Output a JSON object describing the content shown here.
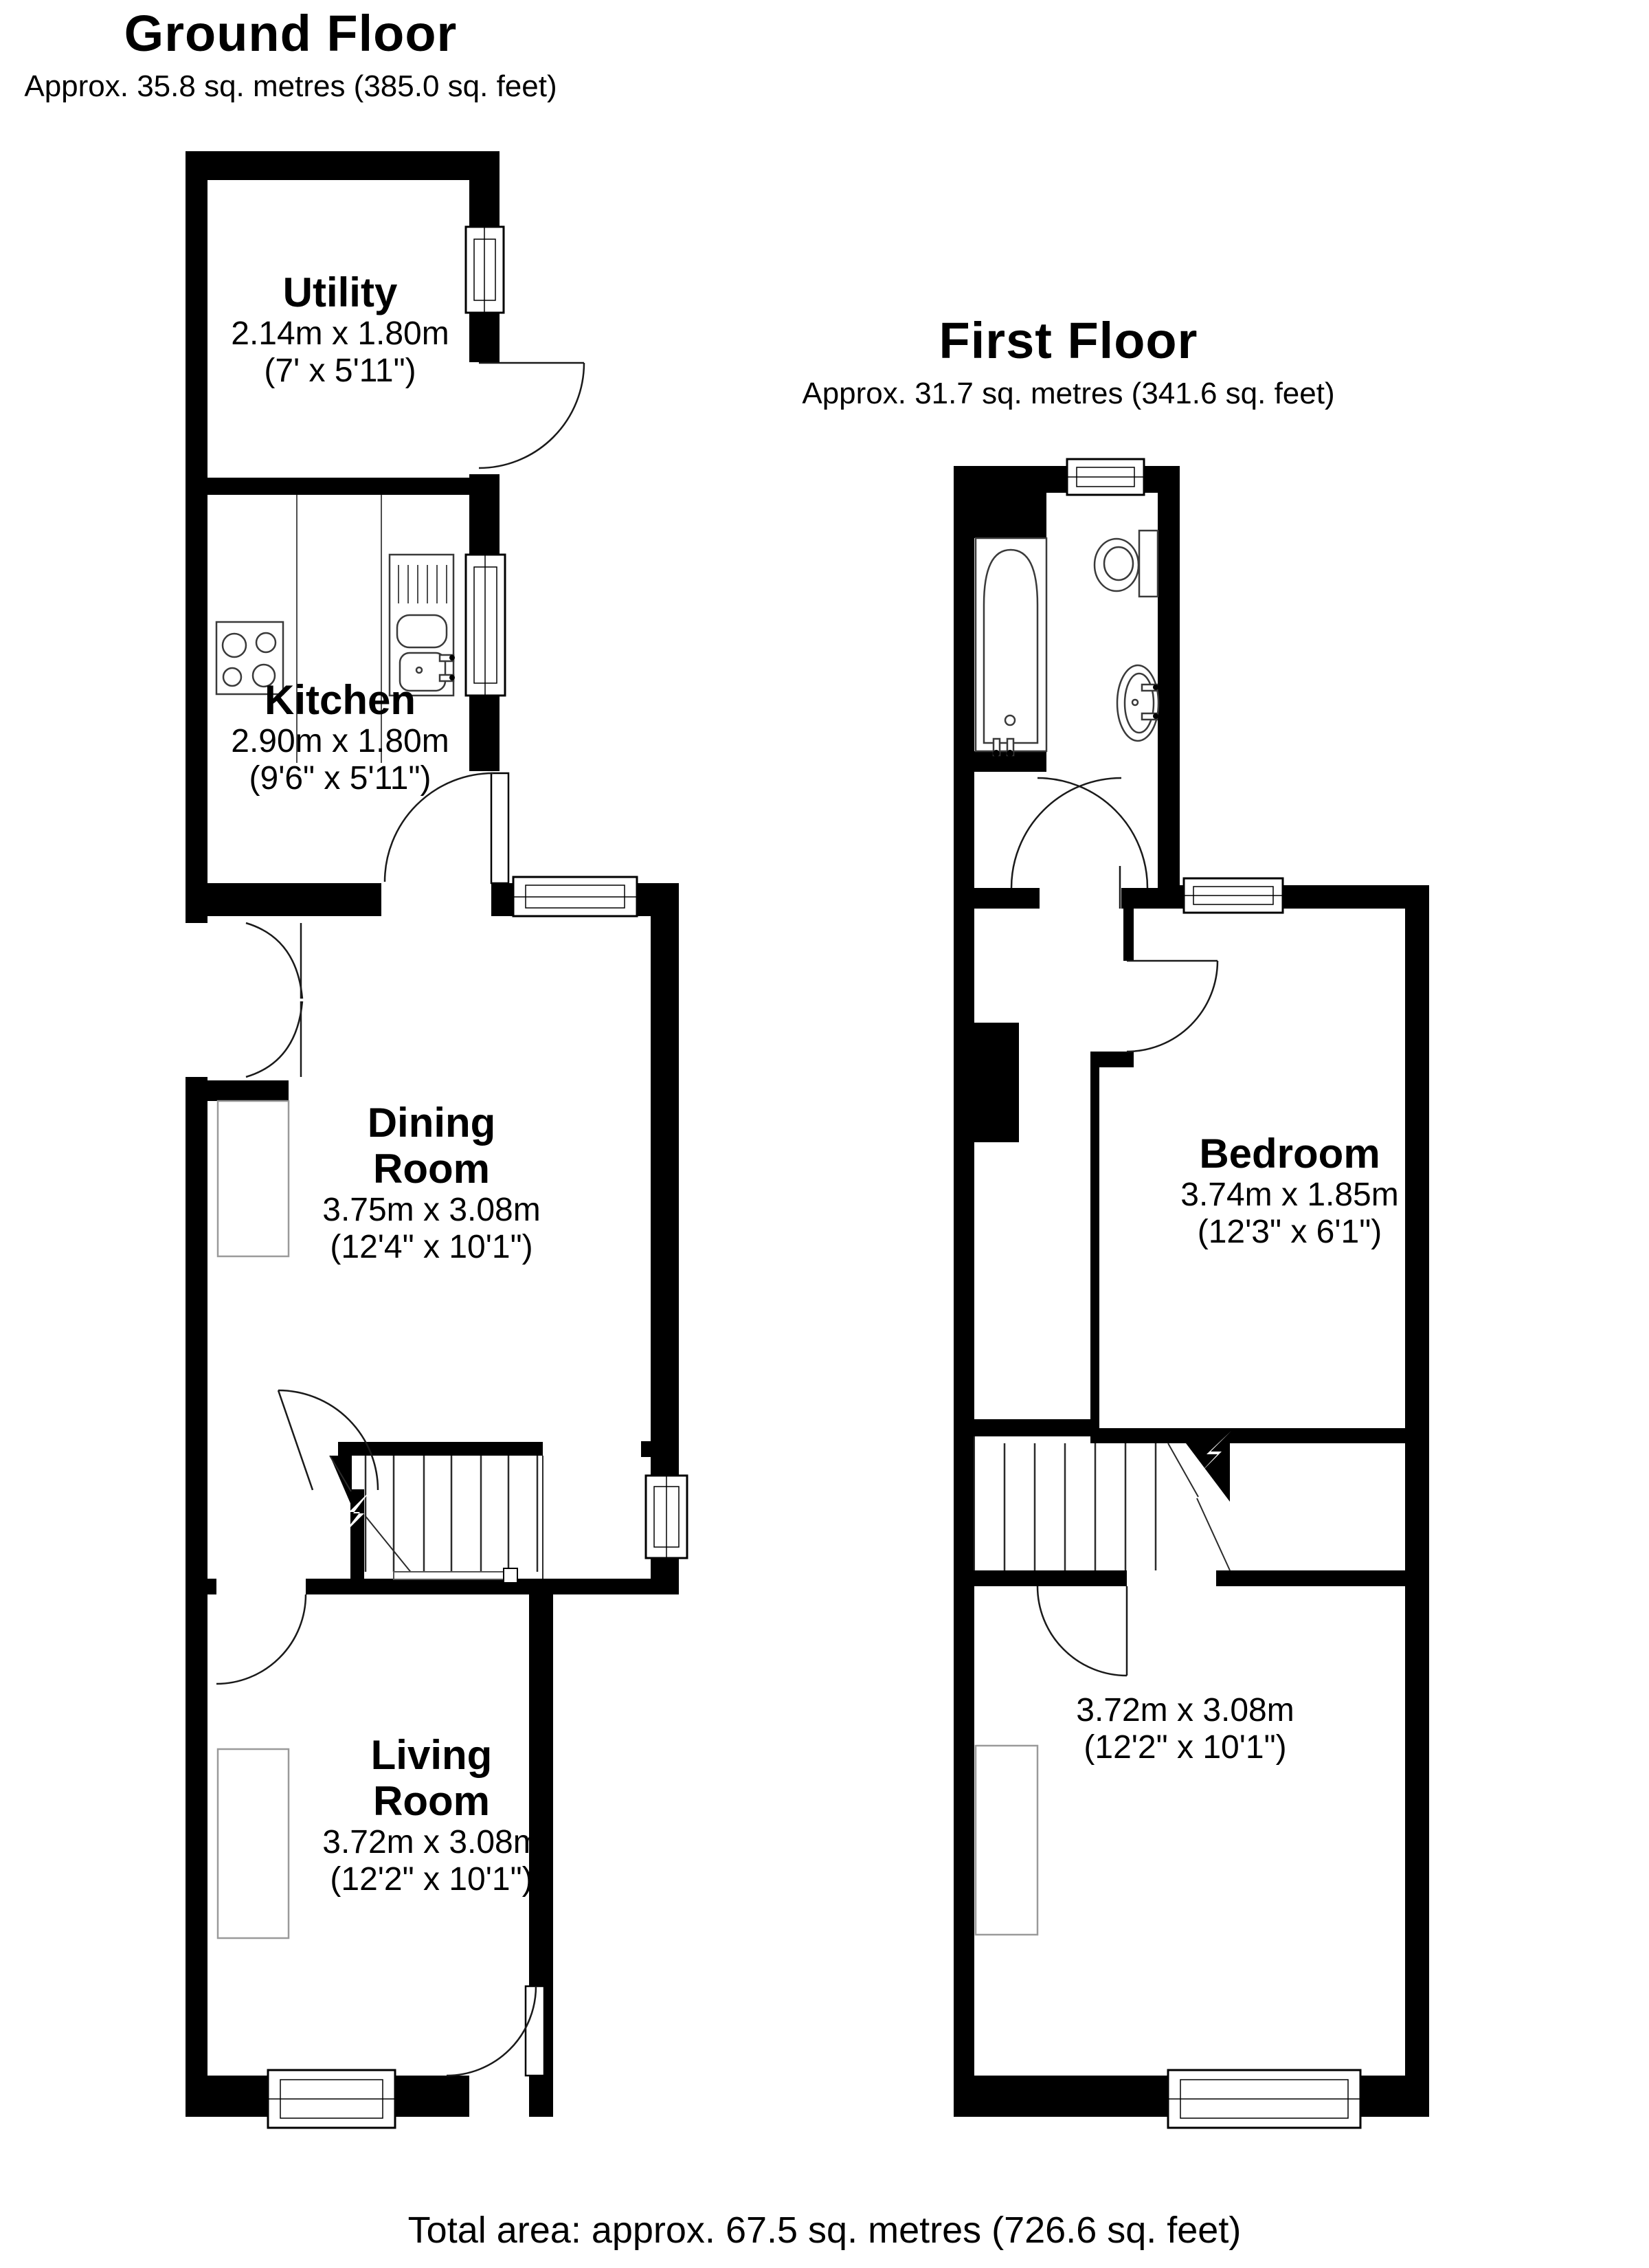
{
  "ground_floor": {
    "title": "Ground Floor",
    "subtitle": "Approx. 35.8 sq. metres (385.0 sq. feet)",
    "rooms": {
      "utility": {
        "name": "Utility",
        "metric": "2.14m x 1.80m",
        "imperial": "(7' x 5'11\")"
      },
      "kitchen": {
        "name": "Kitchen",
        "metric": "2.90m x 1.80m",
        "imperial": "(9'6\" x 5'11\")"
      },
      "dining": {
        "name_line1": "Dining",
        "name_line2": "Room",
        "metric": "3.75m x 3.08m",
        "imperial": "(12'4\" x 10'1\")"
      },
      "living": {
        "name_line1": "Living",
        "name_line2": "Room",
        "metric": "3.72m x 3.08m",
        "imperial": "(12'2\" x 10'1\")"
      }
    }
  },
  "first_floor": {
    "title": "First Floor",
    "subtitle": "Approx. 31.7 sq. metres (341.6 sq. feet)",
    "rooms": {
      "bedroom": {
        "name": "Bedroom",
        "metric": "3.74m x 1.85m",
        "imperial": "(12'3\" x 6'1\")"
      },
      "front_bedroom": {
        "metric": "3.72m x 3.08m",
        "imperial": "(12'2\" x 10'1\")"
      }
    }
  },
  "footer": {
    "total_area": "Total area: approx. 67.5 sq. metres (726.6 sq. feet)"
  }
}
